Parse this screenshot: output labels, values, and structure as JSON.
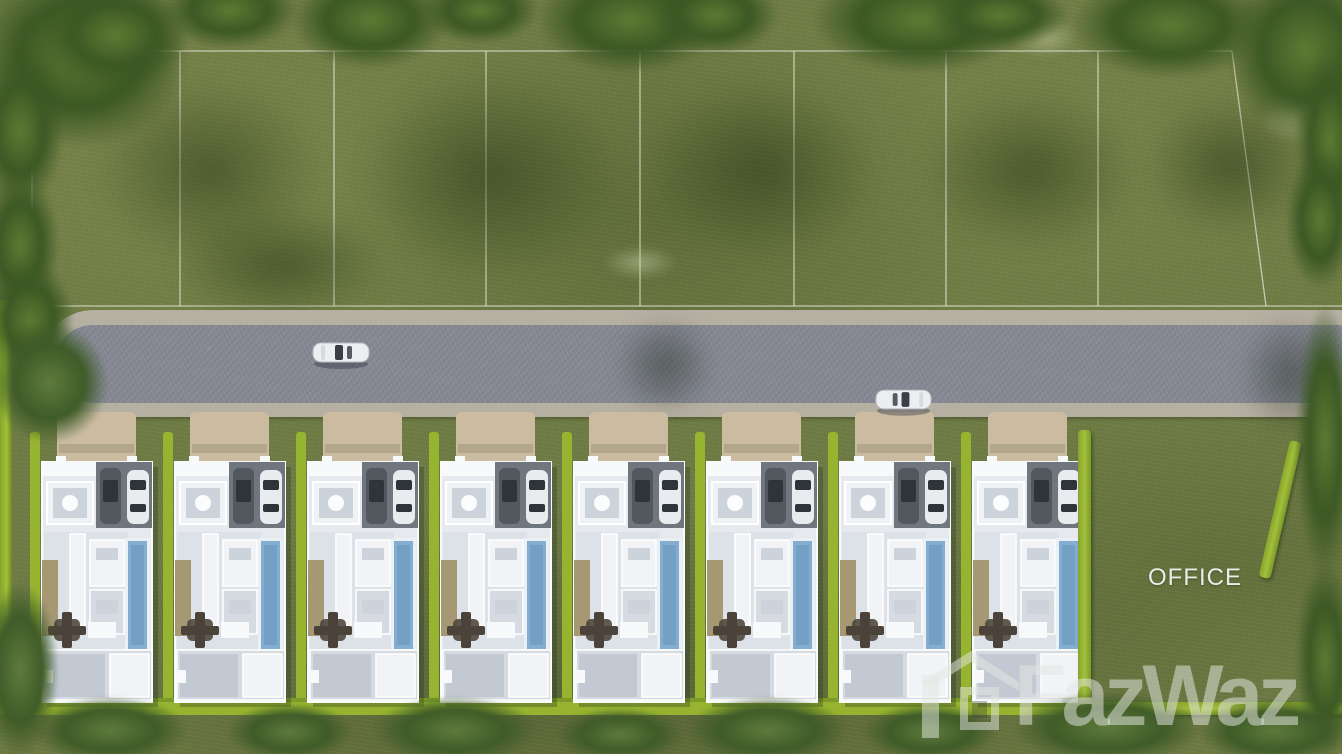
{
  "scene": {
    "title": "Aerial 3D master plan rendering of a pool-villa development",
    "width_px": 1342,
    "height_px": 754
  },
  "labels": {
    "office": "OFFICE"
  },
  "watermark": {
    "brand": "FazWaz",
    "icon": "house-logo-icon"
  },
  "colors": {
    "grass": "#6f7c44",
    "tree": "#3c5824",
    "tree_light": "#5d7a33",
    "hedge": "#96b430",
    "road_asphalt": "#868994",
    "road_curb": "#b6b0a3",
    "driveway": "#cabba1",
    "villa_floor": "#e6eaee",
    "villa_wall": "#f7f9fb",
    "carport": "#70767e",
    "car_dark": "#53585f",
    "car_white": "#e9ecef",
    "pool": "#85add0",
    "deck": "#a59873",
    "table": "#4b4339",
    "office_text": "#e9ece7",
    "watermark_color": "rgba(228,231,226,0.52)"
  },
  "field": {
    "plot_lines": {
      "top_y": 51,
      "bottom_y": 306,
      "left_x": 32,
      "right_x": 1342,
      "verticals": [
        32,
        180,
        334,
        486,
        640,
        794,
        946,
        1098
      ],
      "slanted": {
        "x1": 1232,
        "y1": 51,
        "x2": 1266,
        "y2": 306
      }
    },
    "empty_plots_count": 8
  },
  "road": {
    "x": 40,
    "y": 310,
    "width": 1302,
    "height": 107,
    "rounded_left_end": true
  },
  "cars": [
    {
      "name": "white-car-left",
      "x": 311,
      "y": 339,
      "w": 60,
      "h": 30,
      "heading": "right",
      "color": "white"
    },
    {
      "name": "white-car-right",
      "x": 874,
      "y": 386,
      "w": 59,
      "h": 30,
      "heading": "left",
      "color": "white"
    }
  ],
  "villas": {
    "count": 8,
    "first_left": 30,
    "pitch": 133,
    "top": 412,
    "features": [
      "perimeter-hedge",
      "driveway",
      "carport-two-cars",
      "skylight",
      "swimming-pool",
      "sun-deck",
      "dining-table",
      "bedrooms"
    ]
  },
  "office_plot": {
    "x": 1078,
    "y": 412,
    "w": 264,
    "h": 305,
    "label_xy": [
      1150,
      564
    ]
  },
  "vegetation": {
    "clusters": [
      {
        "x": -30,
        "y": -40,
        "w": 220,
        "h": 190,
        "kind": "tree"
      },
      {
        "x": 40,
        "y": -20,
        "w": 150,
        "h": 110,
        "kind": "tree"
      },
      {
        "x": 160,
        "y": -30,
        "w": 140,
        "h": 80,
        "kind": "tree"
      },
      {
        "x": 290,
        "y": -30,
        "w": 160,
        "h": 100,
        "kind": "tree"
      },
      {
        "x": 420,
        "y": -25,
        "w": 120,
        "h": 70,
        "kind": "tree"
      },
      {
        "x": 535,
        "y": -35,
        "w": 190,
        "h": 110,
        "kind": "tree"
      },
      {
        "x": 650,
        "y": -25,
        "w": 130,
        "h": 80,
        "kind": "tree"
      },
      {
        "x": 810,
        "y": -35,
        "w": 220,
        "h": 110,
        "kind": "tree"
      },
      {
        "x": 930,
        "y": -20,
        "w": 140,
        "h": 70,
        "kind": "tree"
      },
      {
        "x": 1070,
        "y": -30,
        "w": 200,
        "h": 110,
        "kind": "tree"
      },
      {
        "x": 1225,
        "y": -40,
        "w": 160,
        "h": 180,
        "kind": "tree"
      },
      {
        "x": 1295,
        "y": 50,
        "w": 70,
        "h": 180,
        "kind": "tree"
      },
      {
        "x": -25,
        "y": 50,
        "w": 90,
        "h": 160,
        "kind": "tree"
      },
      {
        "x": -20,
        "y": 170,
        "w": 80,
        "h": 150,
        "kind": "tree"
      },
      {
        "x": -15,
        "y": 260,
        "w": 90,
        "h": 120,
        "kind": "tree"
      },
      {
        "x": -10,
        "y": 320,
        "w": 120,
        "h": 125,
        "kind": "bush"
      },
      {
        "x": -20,
        "y": 580,
        "w": 80,
        "h": 180,
        "kind": "bush"
      },
      {
        "x": 1285,
        "y": 150,
        "w": 70,
        "h": 140,
        "kind": "tree"
      },
      {
        "x": 1295,
        "y": 300,
        "w": 60,
        "h": 280,
        "kind": "tree"
      },
      {
        "x": 1295,
        "y": 560,
        "w": 60,
        "h": 200,
        "kind": "tree"
      },
      {
        "x": 30,
        "y": 695,
        "w": 160,
        "h": 70,
        "kind": "bush"
      },
      {
        "x": 225,
        "y": 702,
        "w": 130,
        "h": 60,
        "kind": "bush"
      },
      {
        "x": 370,
        "y": 695,
        "w": 170,
        "h": 70,
        "kind": "bush"
      },
      {
        "x": 555,
        "y": 707,
        "w": 130,
        "h": 55,
        "kind": "bush"
      },
      {
        "x": 685,
        "y": 695,
        "w": 165,
        "h": 70,
        "kind": "bush"
      },
      {
        "x": 860,
        "y": 702,
        "w": 140,
        "h": 60,
        "kind": "bush"
      },
      {
        "x": 1010,
        "y": 690,
        "w": 195,
        "h": 75,
        "kind": "bush"
      },
      {
        "x": 1195,
        "y": 697,
        "w": 160,
        "h": 68,
        "kind": "bush"
      },
      {
        "x": 60,
        "y": 50,
        "w": 300,
        "h": 240,
        "kind": "shadow"
      },
      {
        "x": 320,
        "y": 40,
        "w": 340,
        "h": 270,
        "kind": "shadow"
      },
      {
        "x": 610,
        "y": 55,
        "w": 300,
        "h": 230,
        "kind": "shadow"
      },
      {
        "x": 890,
        "y": 65,
        "w": 280,
        "h": 210,
        "kind": "shadow"
      },
      {
        "x": 1120,
        "y": 75,
        "w": 220,
        "h": 180,
        "kind": "shadow"
      },
      {
        "x": 140,
        "y": 190,
        "w": 280,
        "h": 150,
        "kind": "shadow"
      },
      {
        "x": 1000,
        "y": 10,
        "w": 90,
        "h": 55,
        "kind": "patch"
      },
      {
        "x": 1250,
        "y": 85,
        "w": 85,
        "h": 65,
        "kind": "patch"
      },
      {
        "x": 10,
        "y": 308,
        "w": 70,
        "h": 35,
        "kind": "patch"
      },
      {
        "x": 590,
        "y": 240,
        "w": 100,
        "h": 45,
        "kind": "patch"
      },
      {
        "x": 1225,
        "y": 295,
        "w": 130,
        "h": 160,
        "kind": "roadshadow"
      },
      {
        "x": 600,
        "y": 300,
        "w": 130,
        "h": 130,
        "kind": "roadshadow"
      }
    ]
  }
}
